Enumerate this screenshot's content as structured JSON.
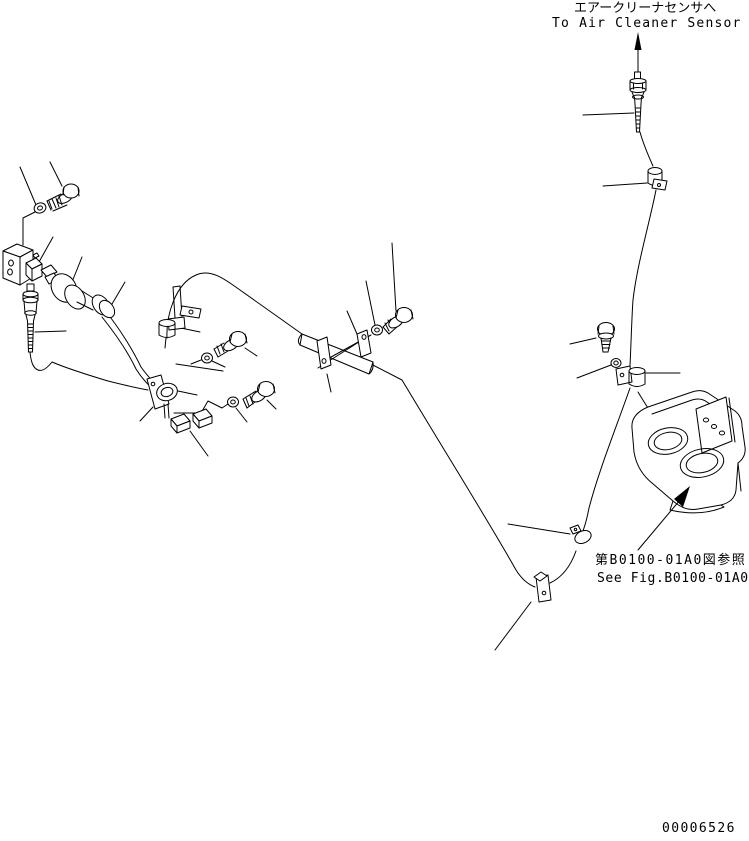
{
  "page": {
    "background_color": "#ffffff",
    "line_color": "#000000"
  },
  "labels": {
    "air_cleaner_sensor_jp": "エアークリーナセンサへ",
    "air_cleaner_sensor_en": "To Air Cleaner Sensor",
    "reference_fig_jp": "第B0100-01A0図参照",
    "reference_fig_en": "See Fig.B0100-01A0",
    "doc_number": "00006526"
  },
  "parts_depicted": [
    "air-cleaner-sensor-connector",
    "hex-bolt",
    "flat-washer",
    "angle-bracket",
    "harness-clip",
    "sensor-assembly",
    "threaded-plug",
    "wiring-harness",
    "stay-bar",
    "harness-clamp",
    "mounting-plate",
    "two-hole-mounting-bracket"
  ]
}
